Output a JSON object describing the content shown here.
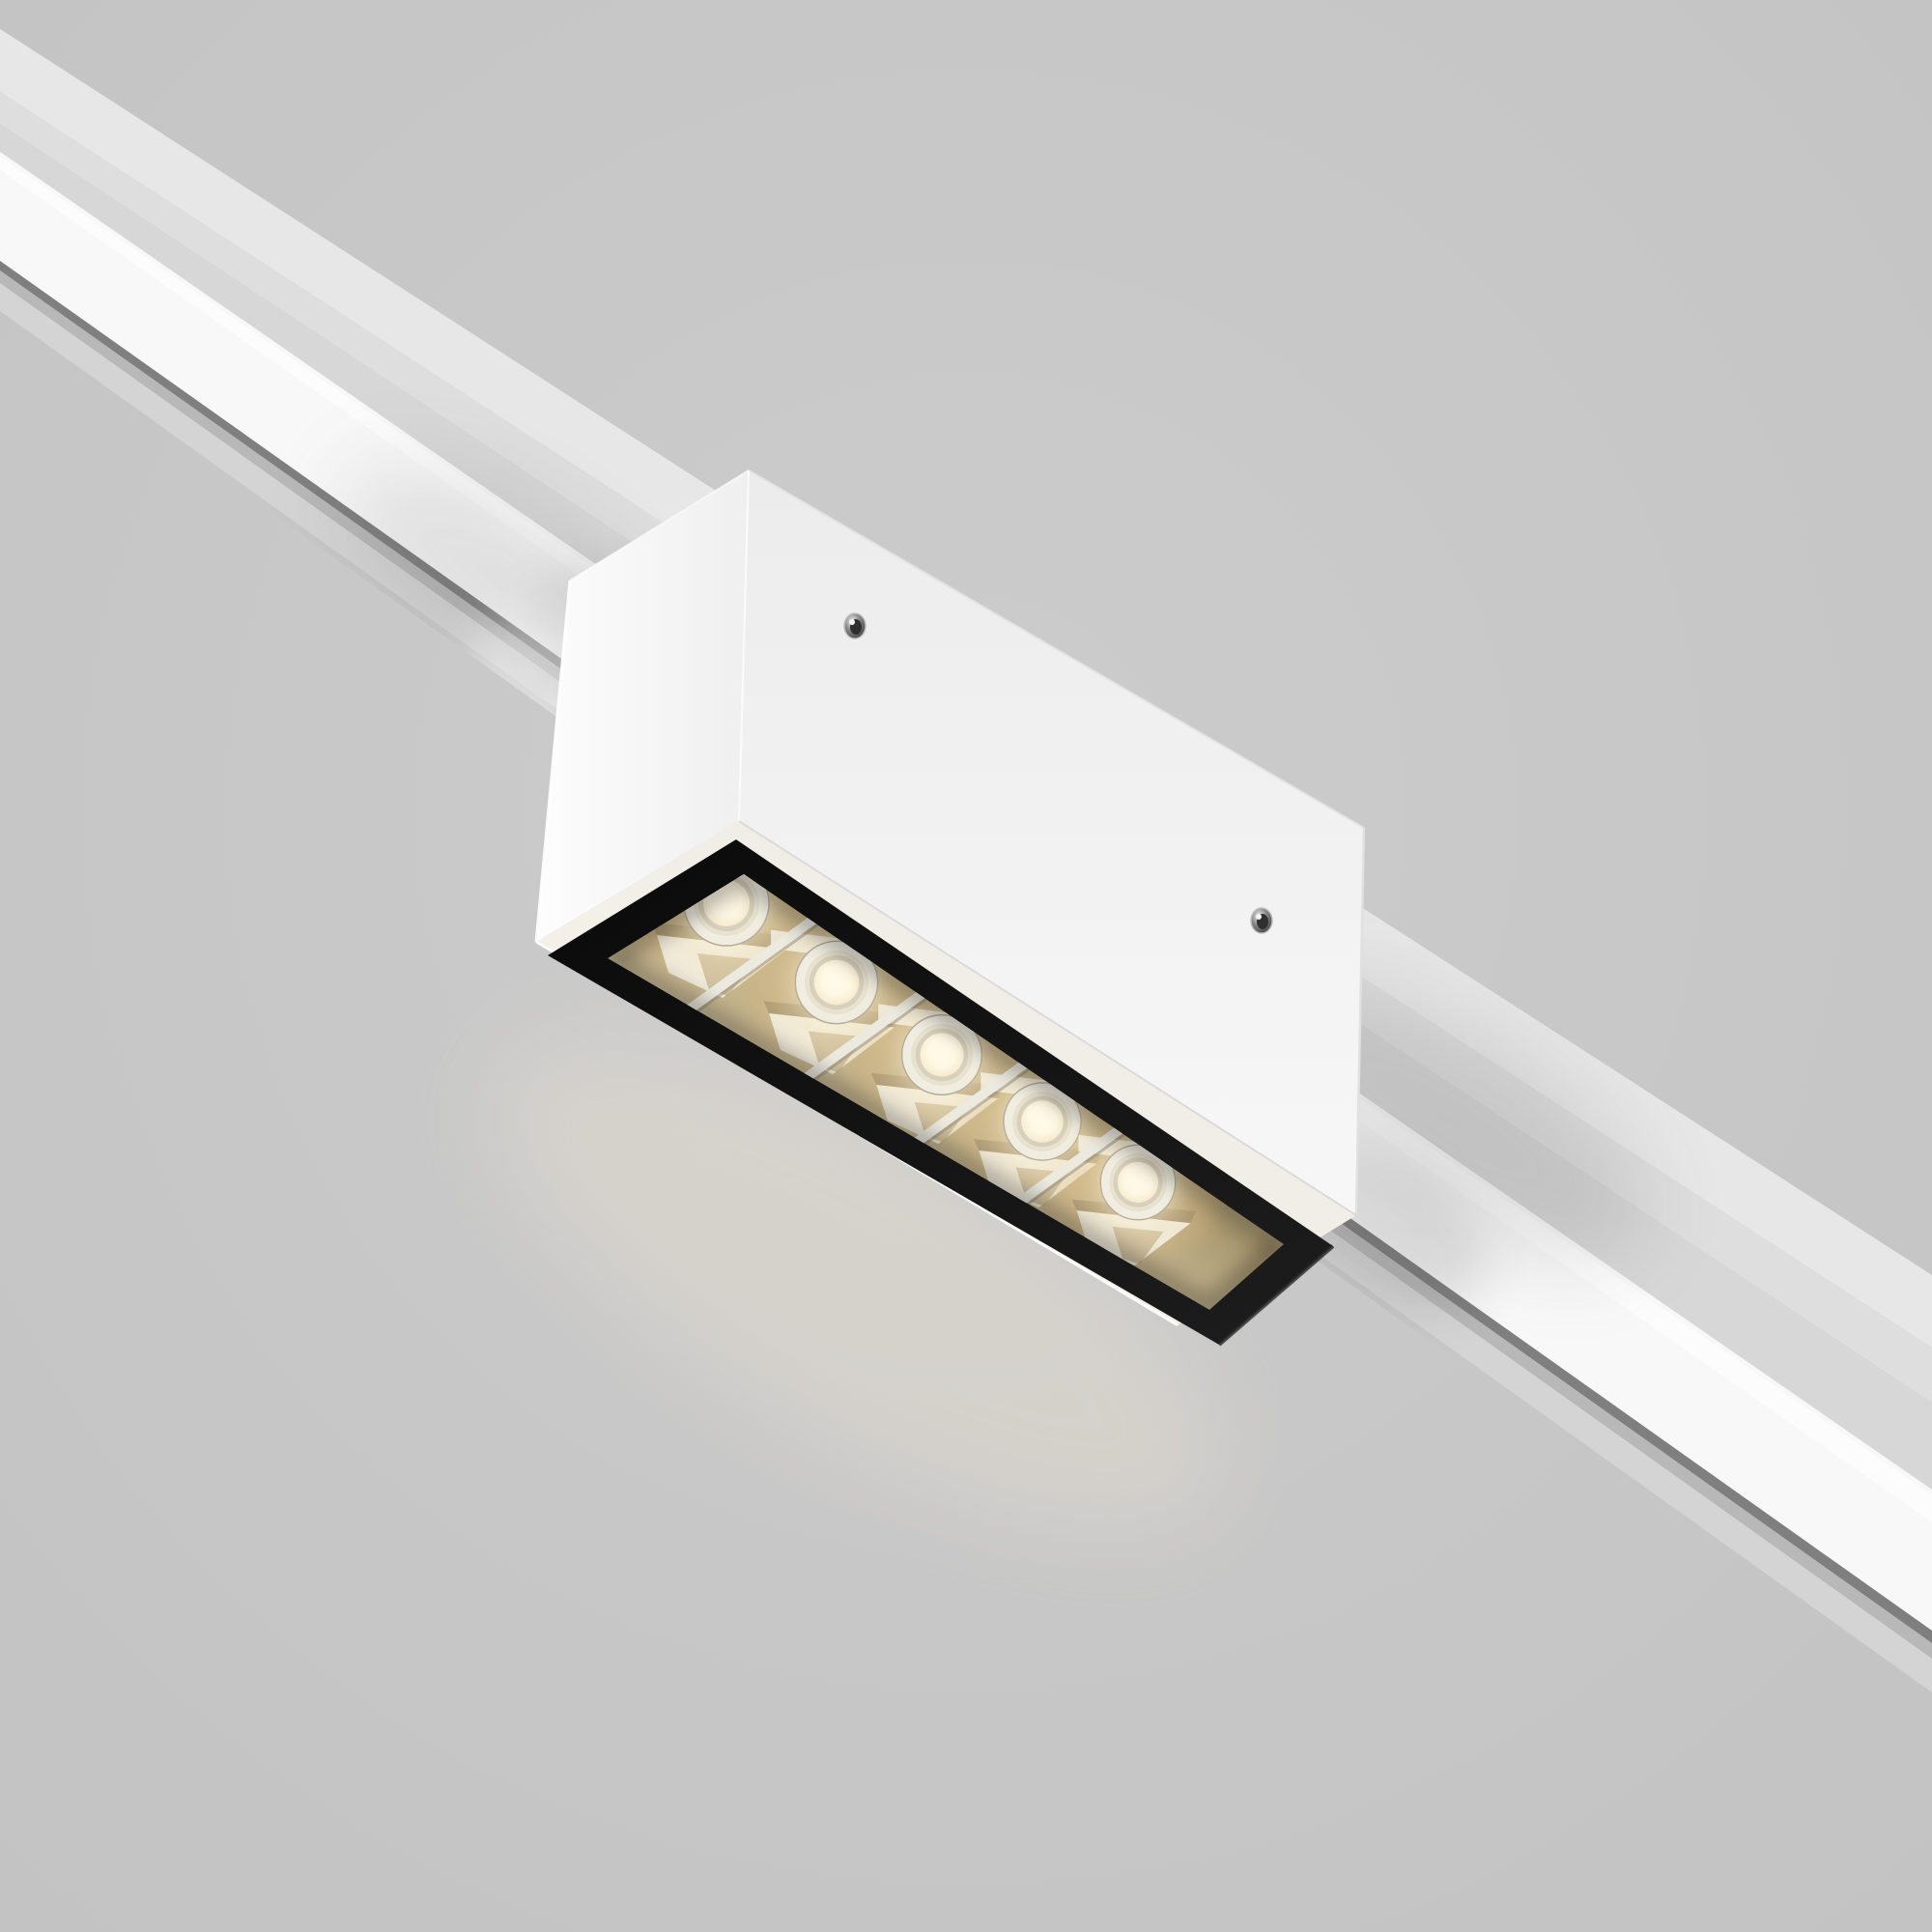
{
  "scene": {
    "type": "product-render",
    "title": "Magnetic track linear LED spotlight",
    "description": "White rectangular track-light fixture clipped onto a white recessed ceiling track, viewed from below; five warm-white LEDs sit in chrome reflector cells behind a black louver frame",
    "led_count": 5,
    "screw_count": 2,
    "track_orientation": "diagonal, upper-left to lower-right"
  },
  "colors": {
    "background": "#c9c9c9",
    "background_edge": "#c3c3c3",
    "track_flange_light": "#e7e7e7",
    "track_flange_mid": "#dedede",
    "track_flange_dark": "#d7d7d7",
    "track_diffuser": "#f8f8f8",
    "track_shadow_line": "#7f7f7f",
    "track_lower_strip": "#d4d4d4",
    "fixture_face_top": "#ececec",
    "fixture_face_bottom": "#f7f7f7",
    "end_face_light": "#fdfdfd",
    "end_face_dark": "#efefef",
    "bottom_face_light": "#faf6ec",
    "bottom_face_dark": "#eae8e3",
    "module_frame": "#0a0a0a",
    "module_frame_sheen": "#1d1d1d",
    "chrome_light": "#f7f6f1",
    "chrome_gold": "#a8976e",
    "chrome_gold_light": "#d5c7a4",
    "led_bezel": "#e9e7e0",
    "led_ring": "#d6d1c3",
    "led_rim": "#b5ad99",
    "led_core": "#fffdf2",
    "led_glow": "#ffeec4",
    "screw_metal": "#8e8e8e",
    "screw_dark": "#3f3f3f",
    "edge_highlight": "#ffffff"
  }
}
